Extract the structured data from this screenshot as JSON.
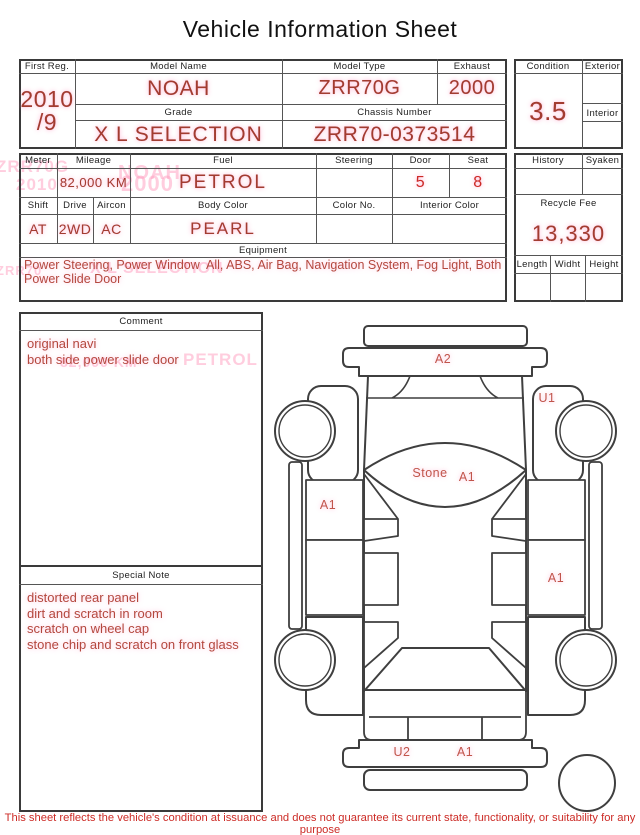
{
  "title": "Vehicle Information Sheet",
  "info": {
    "first_reg": {
      "label": "First Reg.",
      "value_line1": "2010",
      "value_line2": "/9"
    },
    "model_name": {
      "label": "Model Name",
      "value": "NOAH"
    },
    "model_type": {
      "label": "Model Type",
      "value": "ZRR70G"
    },
    "exhaust": {
      "label": "Exhaust",
      "value": "2000"
    },
    "grade": {
      "label": "Grade",
      "value": "X L SELECTION"
    },
    "chassis": {
      "label": "Chassis Number",
      "value": "ZRR70-0373514"
    },
    "condition": {
      "label": "Condition",
      "value": "3.5"
    },
    "exterior": {
      "label": "Exterior",
      "value": ""
    },
    "interior": {
      "label": "Interior",
      "value": ""
    }
  },
  "spec": {
    "meter": {
      "label": "Meter",
      "value": ""
    },
    "mileage": {
      "label": "Mileage",
      "value": "82,000 KM"
    },
    "fuel": {
      "label": "Fuel",
      "value": "PETROL"
    },
    "steering": {
      "label": "Steering",
      "value": ""
    },
    "door": {
      "label": "Door",
      "value": "5"
    },
    "seat": {
      "label": "Seat",
      "value": "8"
    },
    "shift": {
      "label": "Shift",
      "value": "AT"
    },
    "drive": {
      "label": "Drive",
      "value": "2WD"
    },
    "aircon": {
      "label": "Aircon",
      "value": "AC"
    },
    "body_color": {
      "label": "Body Color",
      "value": "PEARL"
    },
    "color_no": {
      "label": "Color No.",
      "value": ""
    },
    "interior_color": {
      "label": "Interior Color",
      "value": ""
    },
    "history": {
      "label": "History",
      "value": ""
    },
    "syaken": {
      "label": "Syaken",
      "value": ""
    },
    "recycle_fee": {
      "label": "Recycle Fee",
      "value": "13,330"
    },
    "length": {
      "label": "Length",
      "value": ""
    },
    "width": {
      "label": "Widht",
      "value": ""
    },
    "height": {
      "label": "Height",
      "value": ""
    }
  },
  "equipment": {
    "label": "Equipment",
    "lines": [
      "Power Steering, Power Window  All, ABS, Air Bag, Navigation System, Fog Light, Both",
      "Power Slide Door"
    ]
  },
  "comment": {
    "label": "Comment",
    "lines": [
      "original navi",
      "both side power slide door"
    ]
  },
  "special_note": {
    "label": "Special Note",
    "lines": [
      "distorted rear panel",
      "dirt and scratch in room",
      "scratch on wheel cap",
      "stone chip and scratch on front glass"
    ]
  },
  "diagram": {
    "labels": [
      {
        "text": "A2",
        "x": 173,
        "y": 41
      },
      {
        "text": "U1",
        "x": 277,
        "y": 80
      },
      {
        "text": "Stone",
        "x": 160,
        "y": 155
      },
      {
        "text": "A1",
        "x": 197,
        "y": 159
      },
      {
        "text": "A1",
        "x": 58,
        "y": 187
      },
      {
        "text": "A1",
        "x": 286,
        "y": 260
      },
      {
        "text": "U2",
        "x": 132,
        "y": 434
      },
      {
        "text": "A1",
        "x": 195,
        "y": 434
      }
    ]
  },
  "ghosts": [
    {
      "text": "ZRR70G",
      "x": -4,
      "y": 157,
      "s": 17
    },
    {
      "text": "2010",
      "x": 16,
      "y": 175,
      "s": 17
    },
    {
      "text": "NOAH",
      "x": 118,
      "y": 162,
      "s": 20
    },
    {
      "text": "2000",
      "x": 121,
      "y": 171,
      "s": 22
    },
    {
      "text": "X L SELECTION",
      "x": 90,
      "y": 260,
      "s": 16
    },
    {
      "text": "ZRR70",
      "x": -4,
      "y": 263,
      "s": 13
    },
    {
      "text": "PETROL",
      "x": 183,
      "y": 350,
      "s": 17
    },
    {
      "text": "82,000 KM",
      "x": 60,
      "y": 354,
      "s": 14
    }
  ],
  "footer": "This sheet reflects the vehicle's condition at issuance and does not guarantee its current state, functionality, or suitability for any purpose",
  "colors": {
    "value_red": "#a23c30",
    "bright_red": "#cc2b26",
    "note_red": "#b4483e",
    "line": "#555555"
  }
}
